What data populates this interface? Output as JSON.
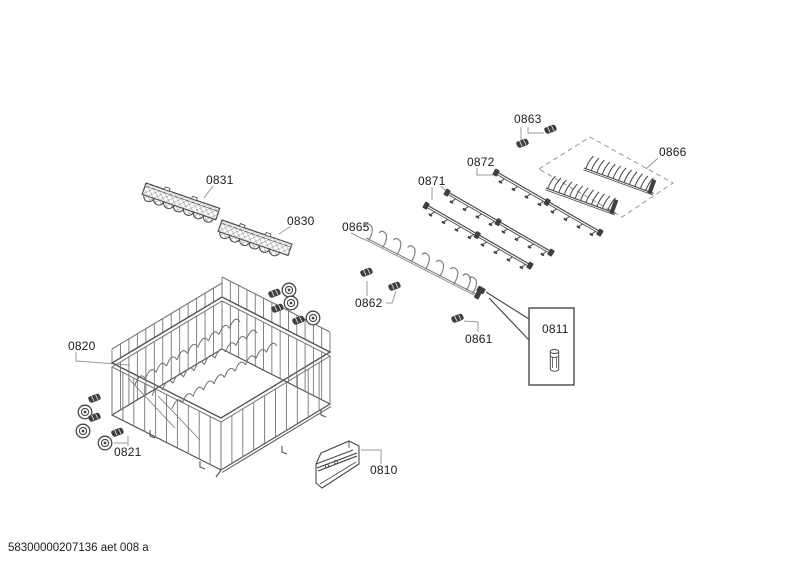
{
  "page": {
    "background": "#ffffff",
    "footer_code": "58300000207136 aet 008 a"
  },
  "diagram": {
    "type": "exploded-parts-diagram",
    "callouts": {
      "c0810": "0810",
      "c0811": "0811",
      "c0820": "0820",
      "c0821": "0821",
      "c0830": "0830",
      "c0831": "0831",
      "c0861": "0861",
      "c0862": "0862",
      "c0863": "0863",
      "c0865": "0865",
      "c0866": "0866",
      "c0871": "0871",
      "c0872": "0872"
    },
    "colors": {
      "part_line": "#4a4a4a",
      "wire_line": "#757575",
      "rim_line": "#555555",
      "hook_line": "#808080",
      "leader_line": "#9a9a9a",
      "label_text": "#1c1c1c",
      "dashed_outline": "#999999",
      "dark_fill": "#3f3f3f",
      "wheel_line": "#474747"
    }
  }
}
